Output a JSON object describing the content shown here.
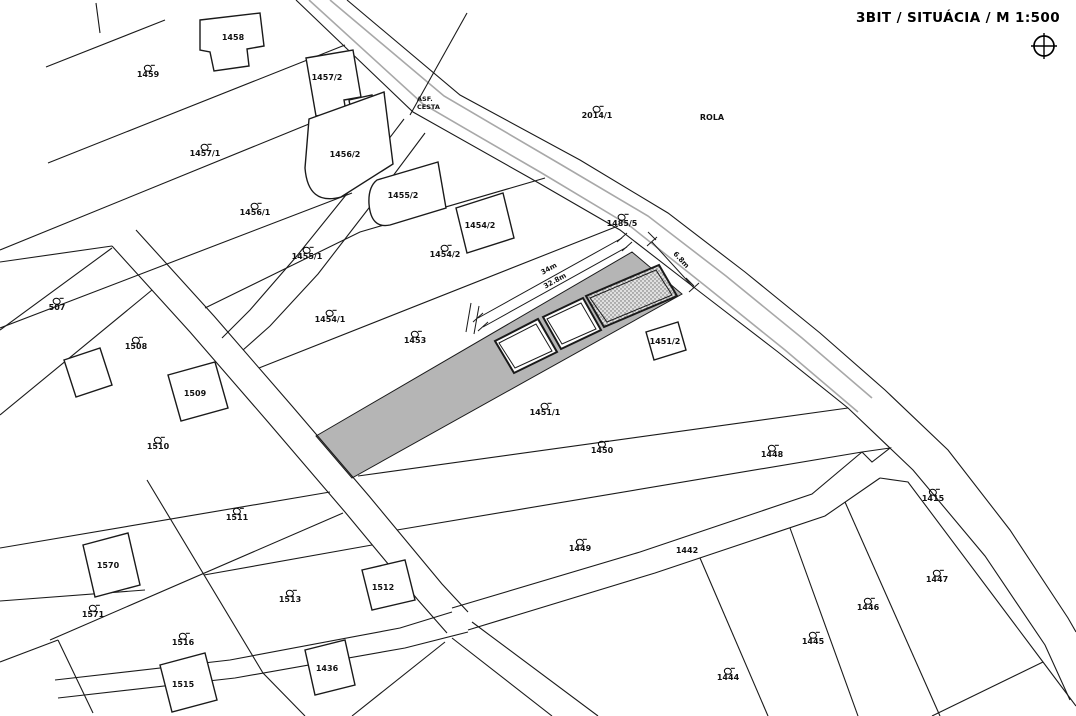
{
  "header": {
    "title": "3BIT / SITUÁCIA  / M 1:500",
    "compass_icon": "crosshair-compass-icon"
  },
  "colors": {
    "line": "#1a1a1a",
    "road_edge_gray": "#a8a8a8",
    "parcel_strip_fill": "#b5b5b5",
    "hatch_fill": "#e0e0e0",
    "hatch_dot": "#666666",
    "background": "#ffffff",
    "text": "#111111"
  },
  "road": {
    "surface_label_line1": "ASF.",
    "surface_label_line2": "CESTA"
  },
  "dimensions": [
    {
      "text": "34m",
      "x": 549,
      "y": 269,
      "rot": -29
    },
    {
      "text": "32.8m",
      "x": 555,
      "y": 281,
      "rot": -29
    },
    {
      "text": "6.8m",
      "x": 681,
      "y": 260,
      "rot": 47
    }
  ],
  "labels": [
    {
      "text": "1459",
      "x": 148,
      "y": 72,
      "sym": true
    },
    {
      "text": "1458",
      "x": 233,
      "y": 38,
      "sym": false
    },
    {
      "text": "1457/2",
      "x": 327,
      "y": 78,
      "sym": false
    },
    {
      "text": "1457/1",
      "x": 205,
      "y": 151,
      "sym": true
    },
    {
      "text": "1456/2",
      "x": 345,
      "y": 155,
      "sym": false
    },
    {
      "text": "1456/1",
      "x": 255,
      "y": 210,
      "sym": true
    },
    {
      "text": "1455/2",
      "x": 403,
      "y": 196,
      "sym": false
    },
    {
      "text": "1455/1",
      "x": 307,
      "y": 254,
      "sym": true
    },
    {
      "text": "1454/2",
      "x": 480,
      "y": 226,
      "sym": false
    },
    {
      "text": "1454/2",
      "x": 445,
      "y": 252,
      "sym": true
    },
    {
      "text": "1454/1",
      "x": 330,
      "y": 317,
      "sym": true
    },
    {
      "text": "2014/1",
      "x": 597,
      "y": 113,
      "sym": true
    },
    {
      "text": "ROLA",
      "x": 712,
      "y": 118,
      "sym": false
    },
    {
      "text": "1485/5",
      "x": 622,
      "y": 221,
      "sym": true
    },
    {
      "text": "507",
      "x": 57,
      "y": 305,
      "sym": true
    },
    {
      "text": "1508",
      "x": 136,
      "y": 344,
      "sym": true
    },
    {
      "text": "1509",
      "x": 195,
      "y": 394,
      "sym": false
    },
    {
      "text": "1510",
      "x": 158,
      "y": 444,
      "sym": true
    },
    {
      "text": "1453",
      "x": 415,
      "y": 338,
      "sym": true
    },
    {
      "text": "1451/2",
      "x": 665,
      "y": 342,
      "sym": false
    },
    {
      "text": "1451/1",
      "x": 545,
      "y": 410,
      "sym": true
    },
    {
      "text": "1450",
      "x": 602,
      "y": 448,
      "sym": true
    },
    {
      "text": "1448",
      "x": 772,
      "y": 452,
      "sym": true
    },
    {
      "text": "1415",
      "x": 933,
      "y": 496,
      "sym": true
    },
    {
      "text": "1511",
      "x": 237,
      "y": 515,
      "sym": true
    },
    {
      "text": "1449",
      "x": 580,
      "y": 546,
      "sym": true
    },
    {
      "text": "1442",
      "x": 687,
      "y": 551,
      "sym": false
    },
    {
      "text": "1447",
      "x": 937,
      "y": 577,
      "sym": true
    },
    {
      "text": "1570",
      "x": 108,
      "y": 566,
      "sym": false
    },
    {
      "text": "1571",
      "x": 93,
      "y": 612,
      "sym": true
    },
    {
      "text": "1513",
      "x": 290,
      "y": 597,
      "sym": true
    },
    {
      "text": "1512",
      "x": 383,
      "y": 588,
      "sym": false
    },
    {
      "text": "1446",
      "x": 868,
      "y": 605,
      "sym": true
    },
    {
      "text": "1516",
      "x": 183,
      "y": 640,
      "sym": true
    },
    {
      "text": "1445",
      "x": 813,
      "y": 639,
      "sym": true
    },
    {
      "text": "1515",
      "x": 183,
      "y": 685,
      "sym": false
    },
    {
      "text": "1436",
      "x": 327,
      "y": 669,
      "sym": false
    },
    {
      "text": "1444",
      "x": 728,
      "y": 675,
      "sym": true
    }
  ]
}
